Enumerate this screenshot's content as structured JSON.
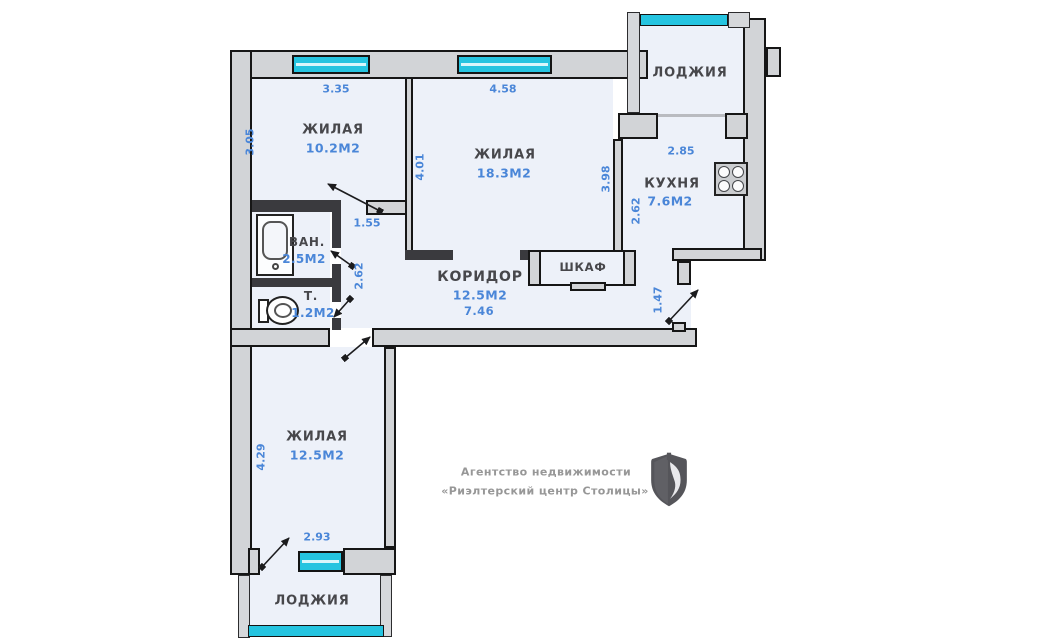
{
  "rooms": {
    "loggia_top": {
      "name": "ЛОДЖИЯ"
    },
    "living_small": {
      "name": "ЖИЛАЯ",
      "area": "10.2М2"
    },
    "living_large": {
      "name": "ЖИЛАЯ",
      "area": "18.3М2"
    },
    "kitchen": {
      "name": "КУХНЯ",
      "area": "7.6М2"
    },
    "bathroom": {
      "name": "ВАН.",
      "area": "2.5М2"
    },
    "toilet": {
      "name": "Т.",
      "area": "1.2М2"
    },
    "corridor": {
      "name": "КОРИДОР",
      "area": "12.5М2",
      "length": "7.46"
    },
    "closet": {
      "name": "ШКАФ"
    },
    "living_bottom": {
      "name": "ЖИЛАЯ",
      "area": "12.5М2"
    },
    "loggia_bottom": {
      "name": "ЛОДЖИЯ"
    }
  },
  "dimensions": {
    "living_small_top": "3.35",
    "living_large_top": "4.58",
    "living_small_left": "3.05",
    "living_large_left": "4.01",
    "living_large_right": "3.98",
    "kitchen_top": "2.85",
    "kitchen_left": "2.62",
    "hall_door": "1.55",
    "bath_wall": "2.62",
    "entry": "1.47",
    "living_bottom_left": "4.29",
    "living_bottom_width": "2.93"
  },
  "agency": {
    "line1": "Агентство недвижимости",
    "line2": "«Риэлтерский центр Столицы»"
  },
  "icons": {
    "stove": "stove-icon",
    "bathtub": "bathtub-icon",
    "toilet": "toilet-icon",
    "shield": "agency-shield-logo"
  },
  "colors": {
    "wall": "#d2d4d7",
    "room_fill": "#edf1f9",
    "window": "#25c4e0",
    "dimension_text": "#4a86d8",
    "label_text": "#47474b",
    "agency_text": "#979797"
  }
}
